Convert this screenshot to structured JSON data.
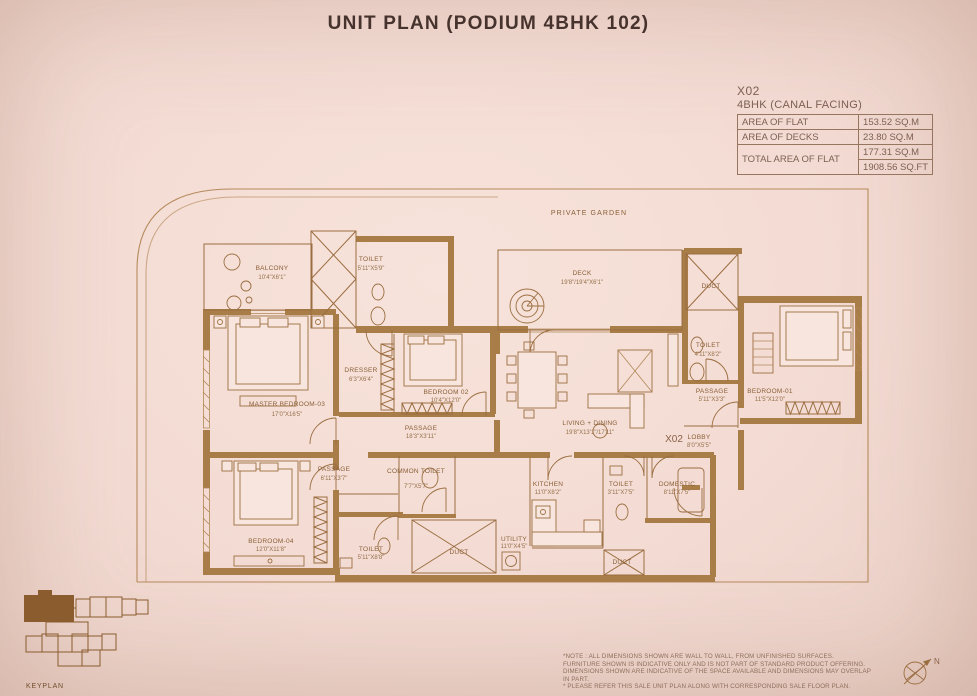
{
  "title": "UNIT PLAN (PODIUM 4BHK 102)",
  "unit_info": {
    "code": "X02",
    "type_label": "4BHK (CANAL FACING)",
    "area_rows": [
      {
        "label": "AREA OF FLAT",
        "value": "153.52 SQ.M"
      },
      {
        "label": "AREA OF DECKS",
        "value": "23.80 SQ.M"
      },
      {
        "label": "TOTAL AREA OF FLAT",
        "value": "177.31 SQ.M"
      },
      {
        "label": "",
        "value": "1908.56 SQ.FT"
      }
    ]
  },
  "plan": {
    "garden_label": "PRIVATE GARDEN",
    "unit_code_label": "X02",
    "rooms": [
      {
        "name": "BALCONY",
        "dim": "10'4\"X6'1\""
      },
      {
        "name": "TOILET",
        "dim": "5'11\"X5'9\""
      },
      {
        "name": "DECK",
        "dim": "19'8\"/19'4\"X6'1\""
      },
      {
        "name": "DUCT",
        "dim": ""
      },
      {
        "name": "MASTER BEDROOM-03",
        "dim": "17'0\"X16'5\""
      },
      {
        "name": "DRESSER",
        "dim": "6'3\"X6'4\""
      },
      {
        "name": "BEDROOM 02",
        "dim": "10'4\"X12'0\""
      },
      {
        "name": "PASSAGE",
        "dim": "18'3\"X3'11\""
      },
      {
        "name": "LIVING + DINING",
        "dim": "19'8\"X13'1\"/17'11\""
      },
      {
        "name": "TOILET",
        "dim": "4'11\"X8'2\""
      },
      {
        "name": "PASSAGE",
        "dim": "5'11\"X3'3\""
      },
      {
        "name": "BEDROOM-01",
        "dim": "11'5\"X12'0\""
      },
      {
        "name": "LOBBY",
        "dim": "8'0\"X5'5\""
      },
      {
        "name": "PASSAGE",
        "dim": "6'11\"X3'7\""
      },
      {
        "name": "BEDROOM-04",
        "dim": "12'0\"X11'8\""
      },
      {
        "name": "TOILET",
        "dim": "5'11\"X8'8\""
      },
      {
        "name": "COMMON TOILET",
        "dim": "7'7\"X5'7\""
      },
      {
        "name": "DUCT",
        "dim": ""
      },
      {
        "name": "UTILITY",
        "dim": "11'0\"X4'5\""
      },
      {
        "name": "KITCHEN",
        "dim": "11'0\"X8'2\""
      },
      {
        "name": "TOILET",
        "dim": "3'11\"X7'5\""
      },
      {
        "name": "DOMESTIC",
        "dim": "8'11\"X7'5\""
      },
      {
        "name": "DUCT",
        "dim": ""
      }
    ]
  },
  "keyplan": {
    "label": "KEYPLAN"
  },
  "compass": {
    "label": "N"
  },
  "notes": [
    "*NOTE : ALL DIMENSIONS SHOWN ARE WALL TO WALL, FROM UNFINISHED SURFACES.",
    "FURNITURE SHOWN IS INDICATIVE ONLY AND IS NOT PART OF STANDARD PRODUCT OFFERING.",
    "DIMENSIONS SHOWN ARE INDICATIVE OF THE SPACE AVAILABLE AND DIMENSIONS MAY OVERLAP IN PART.",
    "* PLEASE REFER THIS SALE UNIT PLAN ALONG WITH CORRESPONDING SALE FLOOR PLAN."
  ],
  "colors": {
    "background": "#f3dbd3",
    "plan_line": "#9b6e41",
    "wall_fill": "#a97d48",
    "title_text": "#47332d",
    "info_text": "#7d6053",
    "keyplan_brown": "#8a5c2e"
  }
}
